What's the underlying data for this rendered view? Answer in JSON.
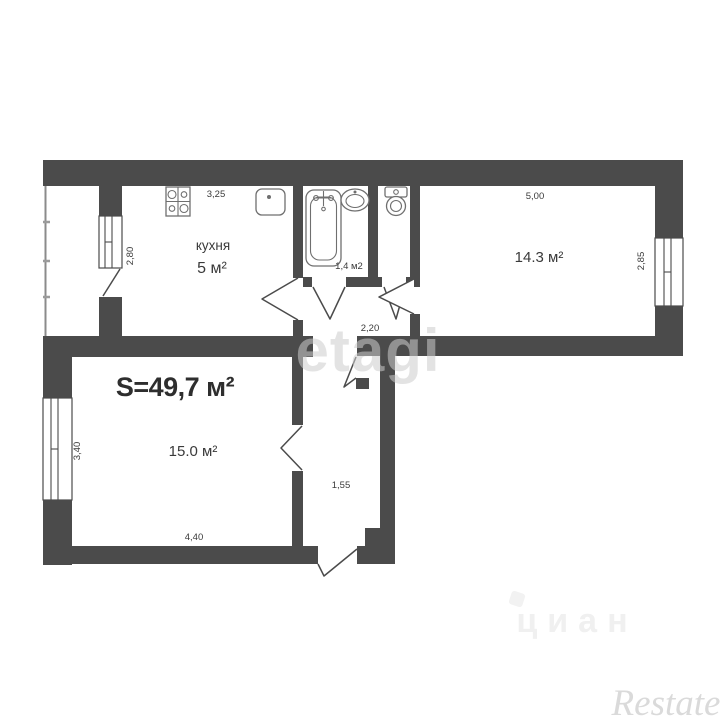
{
  "labels": {
    "total_area": "S=49,7 м²",
    "kitchen_name": "кухня",
    "kitchen_area": "5 м²",
    "bath_area": "1,4 м2",
    "living_room_area": "14.3 м²",
    "bedroom_area": "15.0 м²"
  },
  "dimensions": {
    "kitchen_width": "3,25",
    "kitchen_depth": "2,80",
    "living_width": "5,00",
    "living_depth": "2,85",
    "hall_width": "2,20",
    "bedroom_depth": "3,40",
    "bedroom_width": "4,40",
    "corridor_width": "1,55"
  },
  "watermarks": {
    "center": "etagi",
    "bottom": "циан",
    "corner": "Restate"
  },
  "fixtures": {
    "stove": "stove-icon",
    "sink": "sink-icon",
    "bathtub": "bathtub-icon",
    "washbasin": "washbasin-icon",
    "toilet": "toilet-icon"
  },
  "colors": {
    "wall": "#4b4b4b",
    "text": "#3a3a3a",
    "background": "#ffffff",
    "watermark_center": "#cdcdcd",
    "watermark_bottom": "#f0f0f0",
    "watermark_corner": "#dadada"
  }
}
